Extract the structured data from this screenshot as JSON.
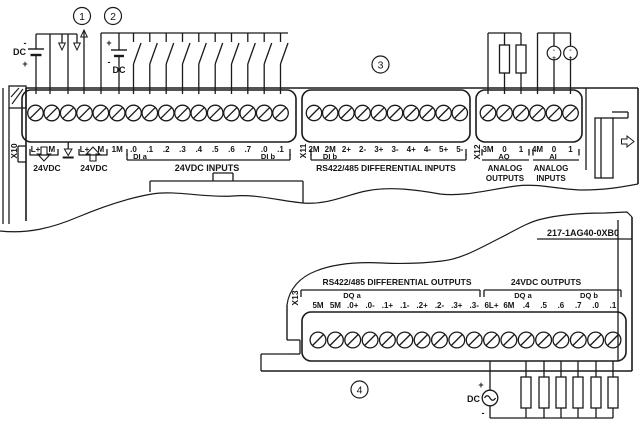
{
  "part_number": "217-1AG40-0XB0",
  "callouts": [
    "1",
    "2",
    "3",
    "4"
  ],
  "symbols": {
    "dc_label": "DC",
    "plus": "+",
    "minus": "-"
  },
  "icons": {
    "earth_ground": "earth-ground-icon",
    "sensor_power_out": "up-arrow-icon",
    "supply_current": "down-arrow-icon",
    "dc_source": "dc-source-icon",
    "load_resistor": "resistor-icon",
    "input_switch": "switch-icon",
    "terminal_screw": "screw-icon"
  },
  "connectors": {
    "x10": {
      "id": "X10",
      "terminals": [
        "L+",
        "M",
        "",
        "L+",
        "M",
        "1M",
        ".0",
        ".1",
        ".2",
        ".3",
        ".4",
        ".5",
        ".6",
        ".7",
        ".0",
        ".1"
      ],
      "sub_labels": [
        "DI a",
        "DI b"
      ],
      "captions": [
        "24VDC",
        "24VDC",
        "24VDC INPUTS"
      ]
    },
    "x11": {
      "id": "X11",
      "terminals": [
        "2M",
        "2M",
        "2+",
        "2-",
        "3+",
        "3-",
        "4+",
        "4-",
        "5+",
        "5-"
      ],
      "sub_label": "DI b",
      "caption": "RS422/485 DIFFERENTIAL INPUTS"
    },
    "x12": {
      "id": "X12",
      "terminals": [
        "3M",
        "0",
        "1",
        "4M",
        "0",
        "1"
      ],
      "sub_labels": [
        "AQ",
        "AI"
      ],
      "captions": [
        "ANALOG",
        "OUTPUTS",
        "ANALOG",
        "INPUTS"
      ]
    },
    "x13": {
      "id": "X13",
      "terminals": [
        "5M",
        "5M",
        ".0+",
        ".0-",
        ".1+",
        ".1-",
        ".2+",
        ".2-",
        ".3+",
        ".3-",
        "6L+",
        "6M",
        ".4",
        ".5",
        ".6",
        ".7",
        ".0",
        ".1"
      ],
      "sub_labels": [
        "DQ a",
        "DQ a",
        "DQ b"
      ],
      "headings": [
        "RS422/485 DIFFERENTIAL OUTPUTS",
        "24VDC OUTPUTS"
      ]
    }
  }
}
